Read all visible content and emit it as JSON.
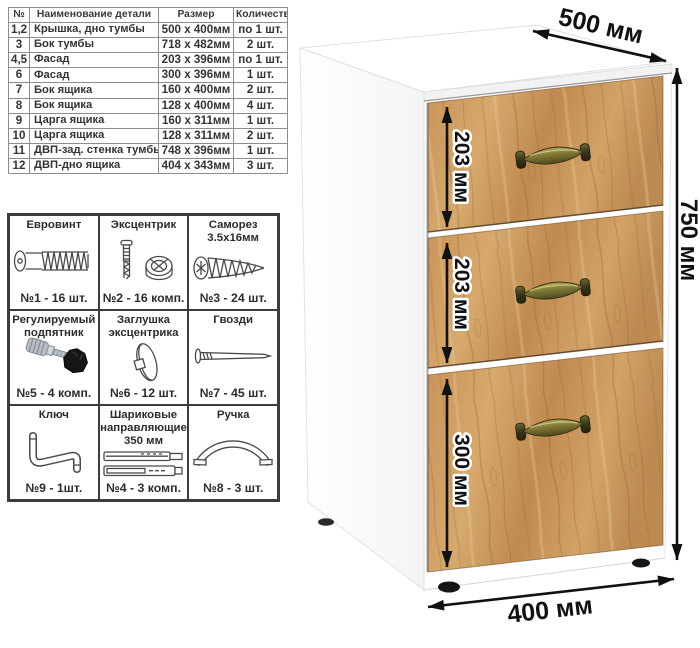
{
  "parts_table": {
    "headers": [
      "№",
      "Наименование детали",
      "Размер",
      "Количество"
    ],
    "rows": [
      [
        "1,2",
        "Крышка, дно тумбы",
        "500 х 400мм",
        "по 1 шт."
      ],
      [
        "3",
        "Бок тумбы",
        "718 х 482мм",
        "2 шт."
      ],
      [
        "4,5",
        "Фасад",
        "203 х 396мм",
        "по 1 шт."
      ],
      [
        "6",
        "Фасад",
        "300 х 396мм",
        "1 шт."
      ],
      [
        "7",
        "Бок ящика",
        "160 х 400мм",
        "2 шт."
      ],
      [
        "8",
        "Бок ящика",
        "128 х 400мм",
        "4 шт."
      ],
      [
        "9",
        "Царга ящика",
        "160 х 311мм",
        "1 шт."
      ],
      [
        "10",
        "Царга ящика",
        "128 х 311мм",
        "2 шт."
      ],
      [
        "11",
        "ДВП-зад. стенка тумбы",
        "748 х 396мм",
        "1 шт."
      ],
      [
        "12",
        "ДВП-дно ящика",
        "404 х 343мм",
        "3 шт."
      ]
    ]
  },
  "hardware": {
    "cells": [
      {
        "title": "Евровинт",
        "count": "№1 - 16 шт.",
        "icon": "euro-screw-icon"
      },
      {
        "title": "Эксцентрик",
        "count": "№2 - 16 комп.",
        "icon": "cam-lock-icon"
      },
      {
        "title": "Саморез 3.5х16мм",
        "count": "№3 - 24 шт.",
        "icon": "self-tapping-screw-icon"
      },
      {
        "title": "Регулируемый подпятник",
        "count": "№5 - 4 комп.",
        "icon": "adjustable-foot-icon"
      },
      {
        "title": "Заглушка эксцентрика",
        "count": "№6 - 12 шт.",
        "icon": "cam-cover-icon"
      },
      {
        "title": "Гвозди",
        "count": "№7 - 45 шт.",
        "icon": "nail-icon"
      },
      {
        "title": "Ключ",
        "count": "№9 - 1шт.",
        "icon": "hex-key-icon"
      },
      {
        "title": "Шариковые направляющие 350 мм",
        "count": "№4 - 3 комп.",
        "icon": "drawer-slides-icon"
      },
      {
        "title": "Ручка",
        "count": "№8 - 3 шт.",
        "icon": "handle-icon"
      }
    ]
  },
  "cabinet": {
    "dims": {
      "depth": "500 мм",
      "height": "750 мм",
      "width": "400 мм",
      "drawer1": "203 мм",
      "drawer2": "203 мм",
      "drawer3": "300 мм"
    },
    "colors": {
      "wood": "#c99257",
      "handle_brass": "#8a8340",
      "carcass": "#ffffff",
      "feet": "#151515",
      "dimension_text": "#111111"
    }
  }
}
